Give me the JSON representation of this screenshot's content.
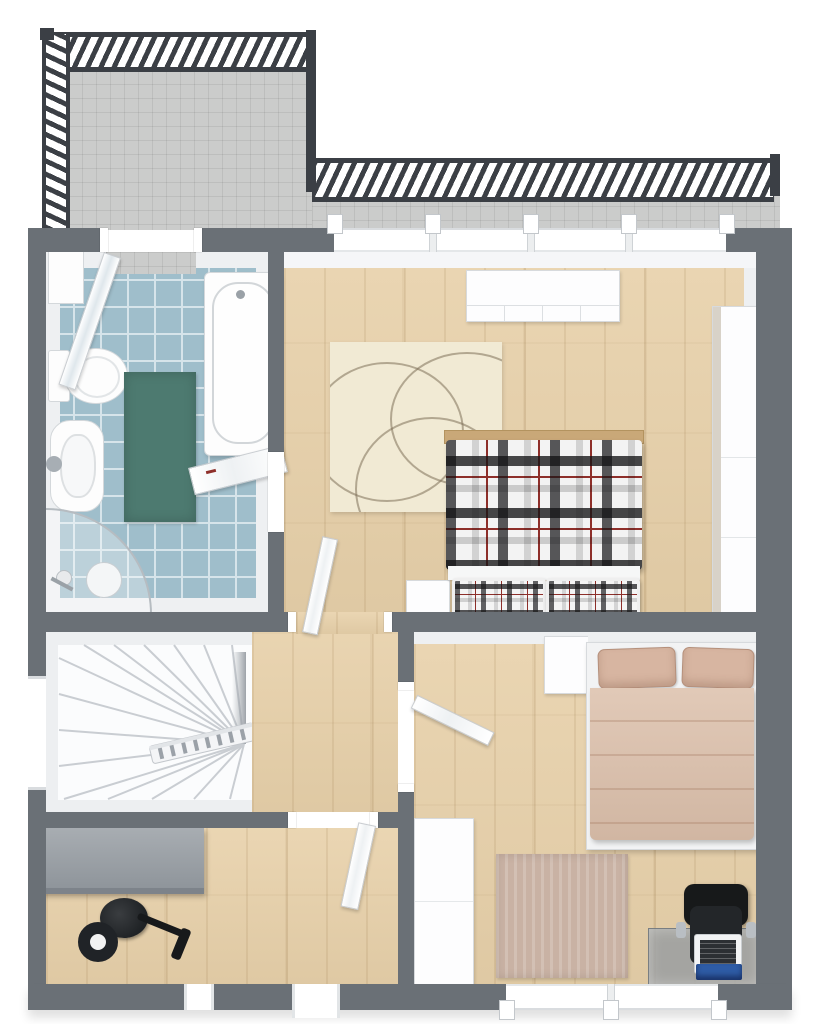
{
  "title": "3D floor plan — upper storey with balcony, bathroom, two bedrooms, stairwell and storage room",
  "palette": {
    "wall": "#6a7076",
    "wallLight": "#eef0f2",
    "wood": "#e8d1aa",
    "tileGray": "#cbcccb",
    "bathTile": "#9fbecb",
    "bathGrout": "#d6e4ea",
    "tealRug": "#4d7a70",
    "creamRug": "#f1ead4",
    "rugLine": "#7d6f57",
    "tanBed": "#dcc0ab",
    "tanPillow": "#d7b5a1",
    "plaidRed": "#8e2f2a",
    "railing": "#3b3f45",
    "cabinetGray": "#9aa0a6",
    "equipmentBlack": "#202326",
    "laptopBlue": "#2e5ca6",
    "beigeRug": "#c9b2a4",
    "stairLine": "#c9cdd2"
  },
  "rooms": [
    {
      "name": "balcony",
      "features": [
        "gray-tiled-floor",
        "metal-railing",
        "balcony-door-to-bathroom"
      ]
    },
    {
      "name": "bathroom",
      "furniture": [
        "bathtub",
        "toilet",
        "sink",
        "corner-shower",
        "wall-shelf",
        "teal-rug",
        "open-door-leaf"
      ]
    },
    {
      "name": "bedroom-top",
      "furniture": [
        "double-bed-plaid",
        "cream-rug-with-circles",
        "low-dresser",
        "tall-wardrobe",
        "small-cabinet",
        "window-band",
        "open-door"
      ]
    },
    {
      "name": "stairwell",
      "furniture": [
        "winder-staircase",
        "handrail"
      ]
    },
    {
      "name": "hallway",
      "furniture": [
        "door-to-bedroom-right",
        "door-to-storage-room"
      ]
    },
    {
      "name": "storage-room",
      "furniture": [
        "gray-sideboard",
        "black-exercise-equipment",
        "exterior-door",
        "small-window"
      ]
    },
    {
      "name": "bedroom-right",
      "furniture": [
        "double-bed-tan",
        "nightstand",
        "beige-rug",
        "glass-desk",
        "office-chair",
        "laptop",
        "blue-notebook",
        "white-wardrobe",
        "window-band"
      ]
    }
  ]
}
